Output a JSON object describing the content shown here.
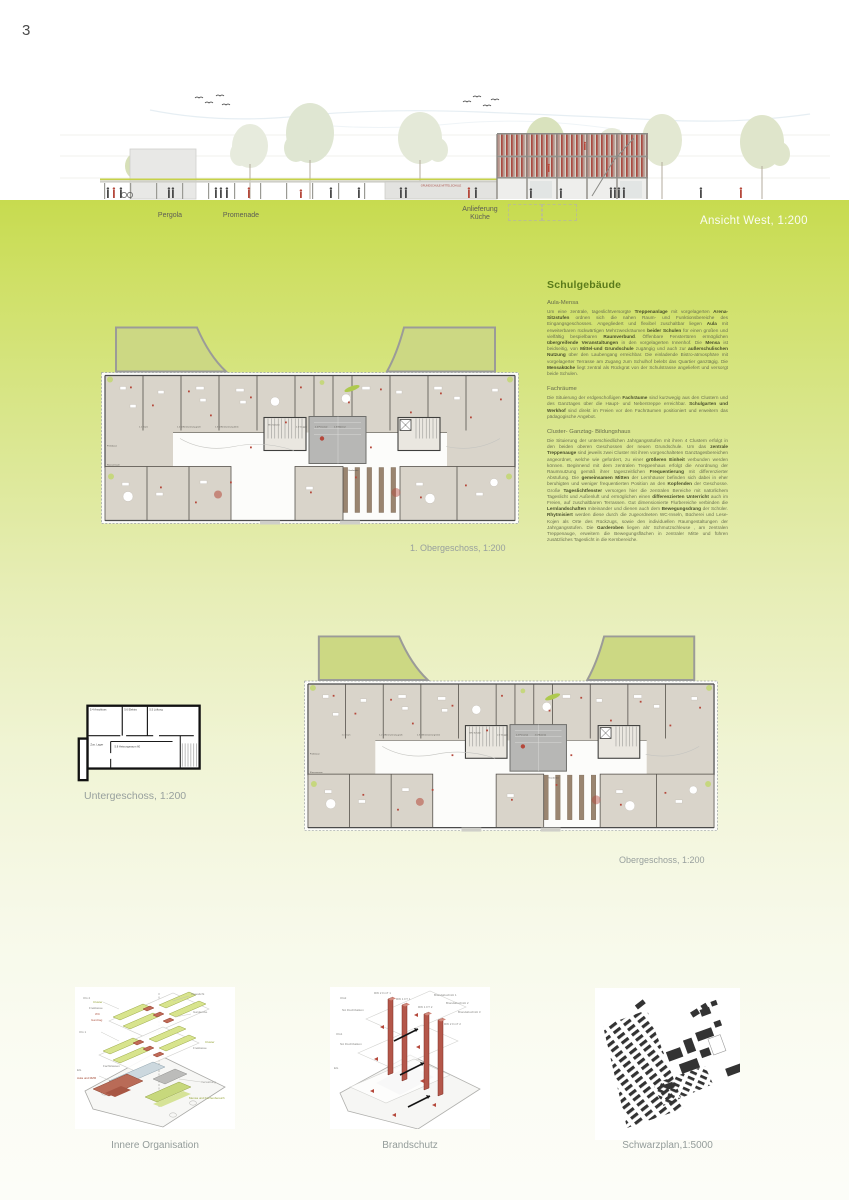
{
  "page": {
    "number": "3"
  },
  "elevation": {
    "caption": "Ansicht West, 1:200",
    "label_pergola": "Pergola",
    "label_promenade": "Promenade",
    "label_anlieferung": "Anlieferung",
    "label_kueche": "Küche",
    "signage": "GRUNDSCHULE  MITTELSCHULE"
  },
  "article": {
    "title": "Schulgebäude",
    "sections": [
      {
        "heading": "Aula-Mensa",
        "body_html": "Um eine zentrale, tageslichtversorgte <b>Treppenanlage</b> mit vorgelagerten <b>Arena-Sitzstufen</b> ordnen sich die nahen Raum- und Funktionsbereiche des Eingangsgeschosses. Angegliedert und flexibel zuschaltbar liegen <b>Aula</b> mit erweiterbaren rückwärtigen Mehrzweckräumen <b>beider Schulen</b> für einen großen und vielfältig bespielbaren <b>Raumverbund</b>. Öffenbare Fenstertüren ermöglichen <b>übergreifende Veranstaltungen</b> in den vorgelagerten Innenhof. Die <b>Mensa</b> ist beidseitig, von <b>Mittel-und Grundschule</b> zugängig und auch zur <b>außerschulischen Nutzung</b> über den Laubengang erreichbar. Die einladende Bistro-atmosphäre mit vorgelagerter Terrasse am Zugang zum Schulhof belebt das Quartier ganztägig. Die <b>Mensaküche</b> liegt zentral als Rückgrat von der Schulstrasse angeliefert und versorgt beide Schulen."
      },
      {
        "heading": "Fachräume",
        "body_html": "Die Situierung der erdgeschoßigen <b>Fachräume</b> sind kurzwegig aus den Clustern und des Ganztages über die Haupt- und Nebentreppe erreichbar. <b>Schulgarten und Werkhof</b> sind direkt im Freien vor den Fachräumen positioniert und erweitern das pädagogische Angebot."
      },
      {
        "heading": "Cluster- Ganztag- Bildungshaus",
        "body_html": "Die Situierung der unterschiedlichen Jahrgangsstufen mit ihren 4 Clustern erfolgt in den beiden oberen Geschossen der neuen Grundschule. Um das <b>zentrale Treppenauge</b> sind jeweils zwei Cluster mit ihren vorgeschalteten Ganztagesbereichen angeordnet, welche wie gefordert, zu einer <b>größeren Einheit</b> verbunden werden können. Beginnend mit dem zentralen Treppenhaus erfolgt die Anordnung der Raumnutzung gemäß ihrer tageszeitlichen <b>Frequentierung</b> mit differenzierter Abstufung. Die <b>gemeinsamen Mitten</b> der Lernhäuser befinden sich dabei in eher beruhigten und weniger frequentierten Position an den <b>Kopfenden</b> der Geschosse. Große <b>Tageslichtfenster</b> versorgen hier die zentralen Bereiche mit natürlichem Tageslicht und Außenluft und ermöglichen einen <b>differenzierten Unterricht</b> auch im Freien, auf zuschaltbaren Terrassen. Gut dimensionierte Flurbereiche verbinden die <b>Lernlandschaften</b> miteinander und dienen auch dem <b>Bewegungsdrang</b> der Schüler. <b>Rhytmisiert</b> werden diese durch die zugeordneten WC-Inseln, Bücherei und Lese- Kojen als Orte des Rückzugs, sowie den individuellen Raumgestaltungen der Jahrgangsstufen. Die <b>Garderoben</b> liegen als' Schmutzschleuse , am zentralen Treppenauge, erweitern die Bewegungsflächen in zentraler Mitte und führen zusätzliches Tageslicht in die Kernbereiche."
      }
    ]
  },
  "plans": {
    "first_upper": {
      "caption": "1. Obergeschoss, 1:200"
    },
    "upper": {
      "caption": "Obergeschoss, 1:200"
    },
    "basement": {
      "caption": "Untergeschoss, 1:200",
      "rooms": {
        "r1": "5.4 Anschluss",
        "r2": "5.6 Elektro",
        "r3": "5.5 Lüftung",
        "r4": "Zus. Lager",
        "r5": "5.8 Heizungsraum 60"
      }
    },
    "room_labels": {
      "t1": "1.1 Team",
      "t2": "1.2 Differenzierung groß",
      "t3": "1.3 Differenzierung klein",
      "t4": "2.1 Gruppe",
      "t5": "2.2 Personal",
      "t6": "2.5 Material",
      "t7": "Klassenraum",
      "t8": "WC Schüler",
      "t9": "Garderobe",
      "t10": "Freiklasse"
    }
  },
  "diagrams": {
    "innere": {
      "caption": "Innere Organisation",
      "levels": {
        "og2": "OG 2",
        "og1": "OG 1",
        "eg": "EG"
      },
      "labels": {
        "tageslicht": "Tageslicht",
        "garderobe": "Garderobe",
        "cluster": "Cluster",
        "freiklasse": "Freiklasse",
        "wc": "WC",
        "ganztag": "Ganztag",
        "fachklassen": "Fachklassen",
        "aula": "Aula und MZR",
        "verwaltung": "Verwaltung",
        "mensa": "Mensa und Küchenbereich"
      }
    },
    "brandschutz": {
      "caption": "Brandschutz",
      "levels": {
        "og2": "OG2",
        "og1": "OG1",
        "eg": "EG"
      },
      "labels": {
        "rw2a": "RW 2 FmT 1",
        "rw1a": "RW 1 FT 1",
        "rw1b": "RW 1 FT 2",
        "rw2b": "RW 2 FmT 2",
        "ba1": "Brandabschnitt 1",
        "ba2": "Brandabschnitt 2",
        "ba3": "Brandabschnitt 3",
        "na": "NA Fluchtbalkon"
      }
    },
    "schwarzplan": {
      "caption": "Schwarzplan,1:5000"
    }
  }
}
